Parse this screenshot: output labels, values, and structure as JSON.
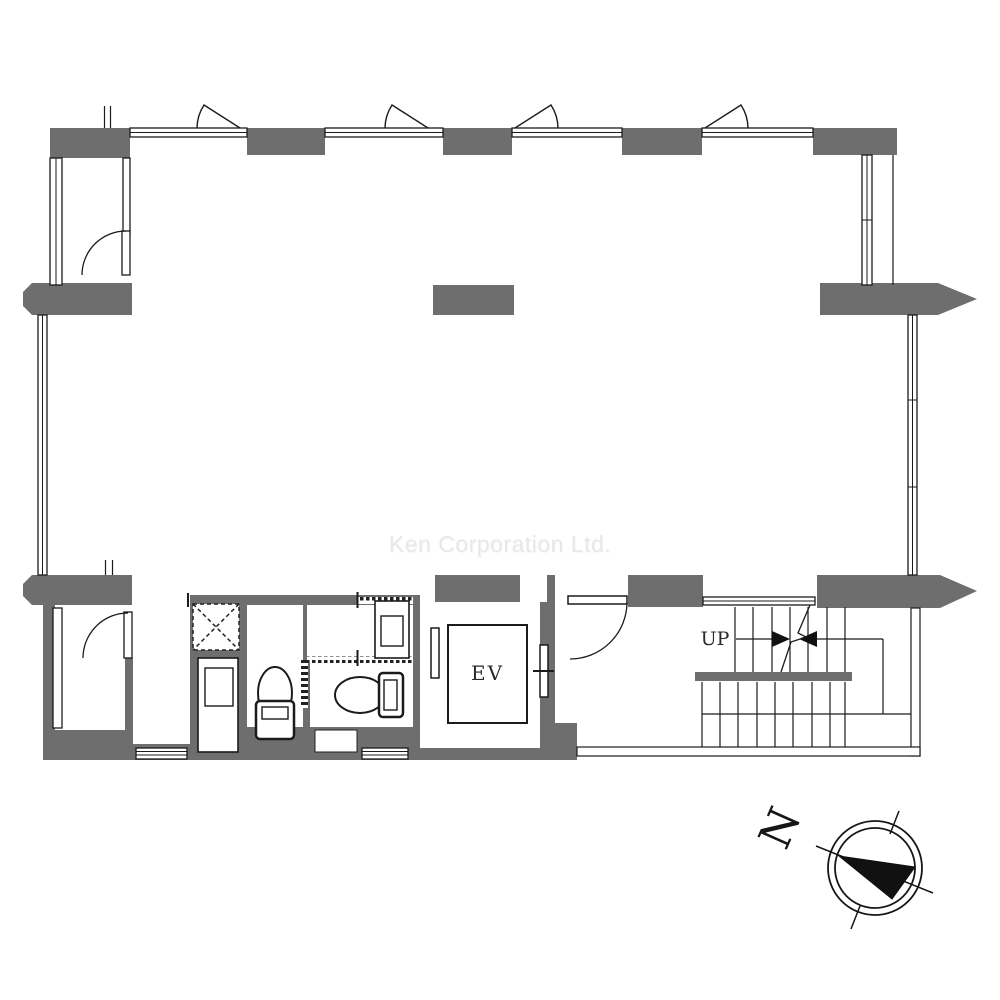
{
  "plan": {
    "watermark": "Ken Corporation Ltd.",
    "elevator_label": "EV",
    "stair_direction_label": "UP",
    "compass_north_label": "N"
  },
  "colors": {
    "background": "#ffffff",
    "wall_fill": "#6e6e6e",
    "line": "#1b1b1b",
    "watermark_text": "#e8e8e8"
  },
  "features": [
    "exterior-walls",
    "casement-windows",
    "balconies",
    "pipe-shaft",
    "toilet-rooms",
    "washbasins",
    "elevator",
    "hall-door",
    "u-shaped-staircase",
    "compass-north-arrow"
  ]
}
